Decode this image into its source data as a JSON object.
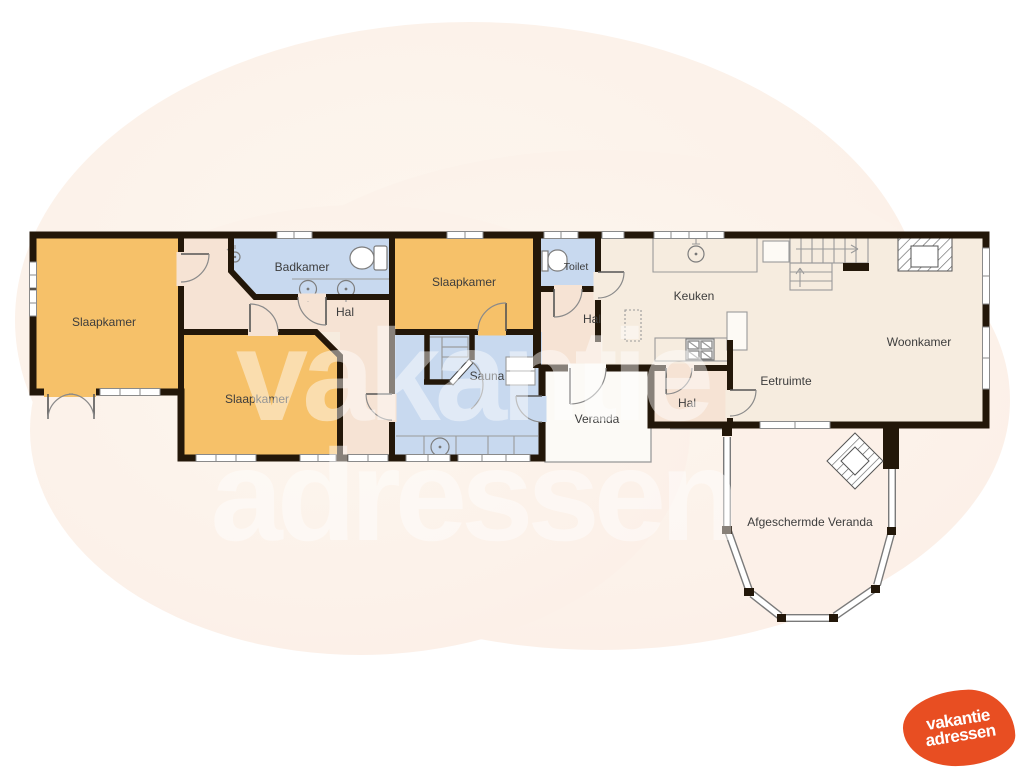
{
  "rooms": {
    "slaapkamer_left": "Slaapkamer",
    "slaapkamer_middle": "Slaapkamer",
    "slaapkamer_right": "Slaapkamer",
    "badkamer": "Badkamer",
    "hal_left": "Hal",
    "hal_middle": "Hal",
    "hal_small": "Hal",
    "toilet": "Toilet",
    "sauna": "Sauna",
    "keuken": "Keuken",
    "woonkamer": "Woonkamer",
    "eetruimte": "Eetruimte",
    "veranda": "Veranda",
    "afgeschermde_veranda": "Afgeschermde Veranda"
  },
  "watermark": {
    "line1": "vakantie",
    "line2": "adressen"
  },
  "logo": {
    "line1": "vakantie",
    "line2": "adressen",
    "background_color": "#e84e22",
    "text_color": "#ffffff"
  },
  "palette": {
    "wall": "#231709",
    "bedroom_fill": "#f6c169",
    "wet_room_fill": "#c8d9ef",
    "floor_fill": "#f6ecdf",
    "hall_fill": "#f6e3d4",
    "veranda_fill": "#fcfaf6",
    "background_blob": "#fcf2ea",
    "label_color": "#3d3d3d"
  },
  "icons": [
    "sink-icon",
    "toilet-icon",
    "shower-icon",
    "stove-icon",
    "stairs-icon",
    "fireplace-icon",
    "hot-tub-icon",
    "bay-window-icon",
    "sauna-door-icon"
  ]
}
